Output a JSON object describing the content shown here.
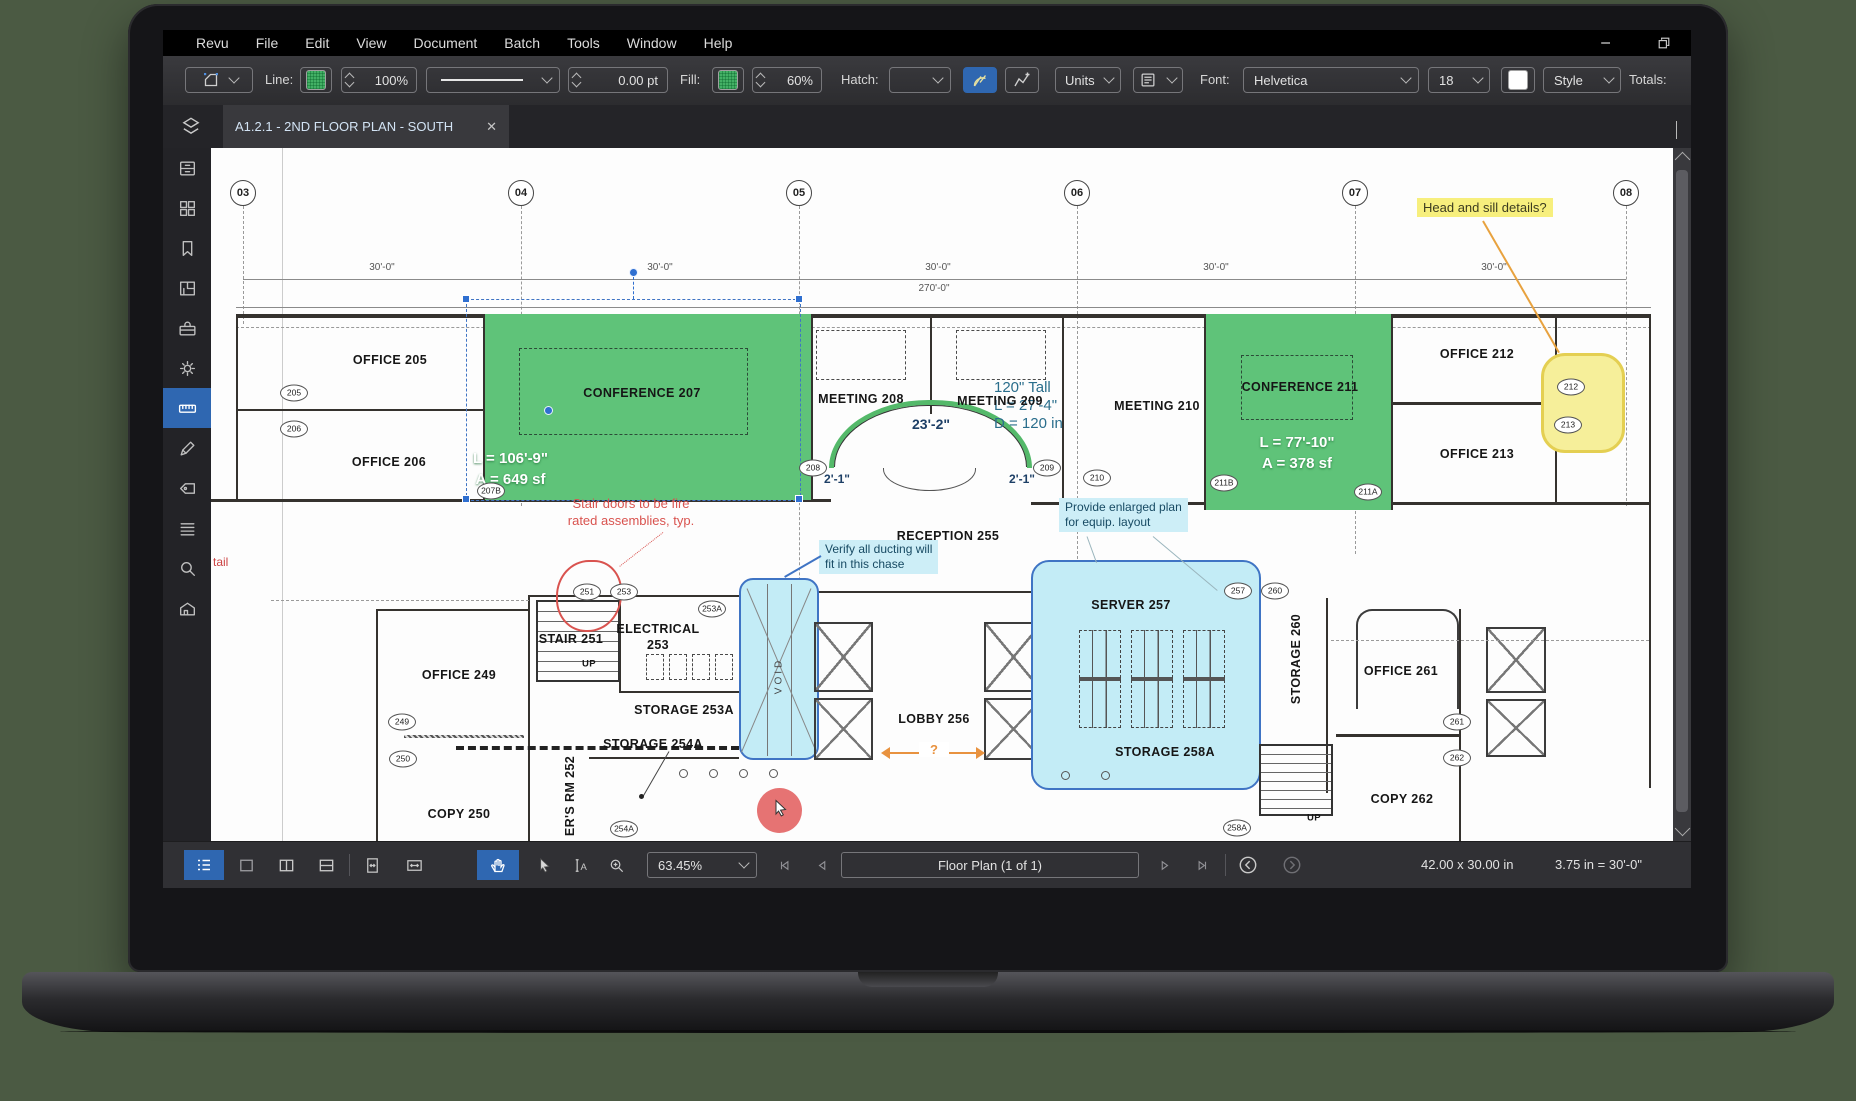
{
  "menubar": {
    "items": [
      "Revu",
      "File",
      "Edit",
      "View",
      "Document",
      "Batch",
      "Tools",
      "Window",
      "Help"
    ]
  },
  "toolbar": {
    "line_label": "Line:",
    "line_opacity": "100%",
    "line_width": "0.00 pt",
    "fill_label": "Fill:",
    "fill_opacity": "60%",
    "hatch_label": "Hatch:",
    "units_label": "Units",
    "font_label": "Font:",
    "font_name": "Helvetica",
    "font_size": "18",
    "style_label": "Style",
    "totals_label": "Totals:"
  },
  "tabbar": {
    "active_tab": "A1.2.1 - 2ND FLOOR PLAN - SOUTH",
    "close": "✕"
  },
  "sidebar": {
    "items": [
      {
        "name": "file-access-icon"
      },
      {
        "name": "thumbnails-icon"
      },
      {
        "name": "bookmarks-icon"
      },
      {
        "name": "spaces-icon"
      },
      {
        "name": "toolbox-icon"
      },
      {
        "name": "settings-icon"
      },
      {
        "name": "measurements-icon",
        "active": true
      },
      {
        "name": "markup-icon"
      },
      {
        "name": "tags-icon"
      },
      {
        "name": "sets-icon"
      },
      {
        "name": "search-icon"
      },
      {
        "name": "model-icon"
      }
    ]
  },
  "statusbar": {
    "zoom": "63.45%",
    "page": "Floor Plan (1 of 1)",
    "doc_size": "42.00 x 30.00 in",
    "scale": "3.75 in = 30'-0\""
  },
  "plan": {
    "grid": [
      {
        "t": "03",
        "x": 32,
        "h": 118
      },
      {
        "t": "04",
        "x": 310,
        "h": 300
      },
      {
        "t": "05",
        "x": 588,
        "h": 550
      },
      {
        "t": "06",
        "x": 866,
        "h": 358
      },
      {
        "t": "07",
        "x": 1144,
        "h": 348
      },
      {
        "t": "08",
        "x": 1415,
        "h": 300
      }
    ],
    "dim_overall": "270'-0\"",
    "bay_dim": "30'-0\"",
    "bay_xs": [
      171,
      449,
      727,
      1005,
      1283
    ],
    "rooms": [
      {
        "t": "OFFICE  205",
        "x": 179,
        "y": 212
      },
      {
        "t": "OFFICE  206",
        "x": 178,
        "y": 314
      },
      {
        "t": "CONFERENCE  207",
        "x": 431,
        "y": 245
      },
      {
        "t": "MEETING  208",
        "x": 650,
        "y": 251
      },
      {
        "t": "MEETING  209",
        "x": 789,
        "y": 253
      },
      {
        "t": "MEETING  210",
        "x": 946,
        "y": 258
      },
      {
        "t": "CONFERENCE  211",
        "x": 1089,
        "y": 239
      },
      {
        "t": "OFFICE  212",
        "x": 1266,
        "y": 206
      },
      {
        "t": "OFFICE  213",
        "x": 1266,
        "y": 306
      },
      {
        "t": "RECEPTION  255",
        "x": 737,
        "y": 388
      },
      {
        "t": "OFFICE  249",
        "x": 248,
        "y": 527
      },
      {
        "t": "COPY  250",
        "x": 248,
        "y": 666
      },
      {
        "t": "STAIR 251",
        "x": 360,
        "y": 491
      },
      {
        "t": "UP",
        "x": 378,
        "y": 516,
        "c": "sm"
      },
      {
        "t": "ELECTRICAL",
        "x": 447,
        "y": 481
      },
      {
        "t": "253",
        "x": 447,
        "y": 497
      },
      {
        "t": "STORAGE 253A",
        "x": 473,
        "y": 562
      },
      {
        "t": "STORAGE 254A",
        "x": 442,
        "y": 596
      },
      {
        "t": "ER'S RM 252",
        "x": 359,
        "y": 648,
        "c": "v"
      },
      {
        "t": "LOBBY  256",
        "x": 723,
        "y": 571
      },
      {
        "t": "SERVER  257",
        "x": 920,
        "y": 457
      },
      {
        "t": "STORAGE 258A",
        "x": 954,
        "y": 604
      },
      {
        "t": "STORAGE 260",
        "x": 1085,
        "y": 511,
        "c": "v"
      },
      {
        "t": "VOID",
        "x": 568,
        "y": 528,
        "c": "v vd"
      },
      {
        "t": "UP",
        "x": 1103,
        "y": 670,
        "c": "sm"
      },
      {
        "t": "OFFICE  261",
        "x": 1190,
        "y": 523
      },
      {
        "t": "COPY  262",
        "x": 1191,
        "y": 651
      }
    ],
    "tags": [
      {
        "t": "205",
        "x": 83,
        "y": 245
      },
      {
        "t": "206",
        "x": 83,
        "y": 281
      },
      {
        "t": "207B",
        "x": 280,
        "y": 343
      },
      {
        "t": "208",
        "x": 602,
        "y": 320
      },
      {
        "t": "209",
        "x": 836,
        "y": 320
      },
      {
        "t": "210",
        "x": 886,
        "y": 330
      },
      {
        "t": "211B",
        "x": 1013,
        "y": 335
      },
      {
        "t": "211A",
        "x": 1157,
        "y": 344
      },
      {
        "t": "212",
        "x": 1360,
        "y": 239
      },
      {
        "t": "213",
        "x": 1357,
        "y": 277
      },
      {
        "t": "249",
        "x": 191,
        "y": 574
      },
      {
        "t": "250",
        "x": 192,
        "y": 611
      },
      {
        "t": "251",
        "x": 376,
        "y": 444
      },
      {
        "t": "253",
        "x": 413,
        "y": 444
      },
      {
        "t": "253A",
        "x": 501,
        "y": 461
      },
      {
        "t": "254A",
        "x": 413,
        "y": 681
      },
      {
        "t": "257",
        "x": 1027,
        "y": 443
      },
      {
        "t": "260",
        "x": 1064,
        "y": 443
      },
      {
        "t": "258A",
        "x": 1026,
        "y": 680
      },
      {
        "t": "261",
        "x": 1246,
        "y": 574
      },
      {
        "t": "262",
        "x": 1246,
        "y": 610
      }
    ],
    "conf207": {
      "l": "L = 106'-9\"",
      "a": "A = 649 sf"
    },
    "conf211": {
      "l": "L = 77'-10\"",
      "a": "A = 378 sf"
    },
    "arc_dim": "23'-2\"",
    "readout": [
      "120\" Tall",
      "L = 27'-4\"",
      "D = 120 in"
    ],
    "dim_left": "2'-1\"",
    "dim_right": "2'-1\"",
    "question": "?",
    "tail_text": "tail",
    "notes": {
      "yellow": "Head and sill details?",
      "red": [
        "Stair doors to be fire",
        "rated assemblies, typ."
      ],
      "duct": [
        "Verify all ducting will",
        "fit in this chase"
      ],
      "equip": [
        "Provide enlarged plan",
        "for equip. layout"
      ]
    }
  }
}
